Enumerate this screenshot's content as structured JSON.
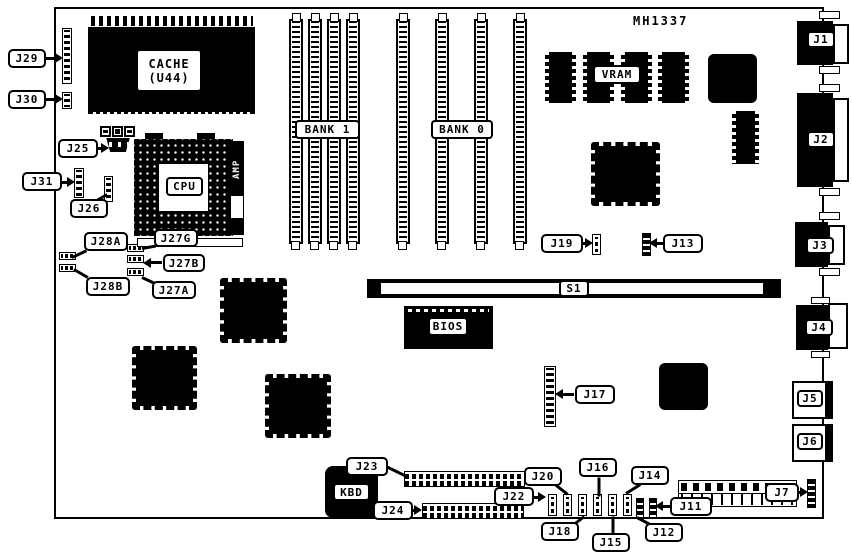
{
  "title_text": "MH1337",
  "components": {
    "cache_line1": "CACHE",
    "cache_line2": "(U44)",
    "cpu": "CPU",
    "amp": "AMP",
    "bank1": "BANK 1",
    "bank0": "BANK 0",
    "vram": "VRAM",
    "bios": "BIOS",
    "s1": "S1",
    "kbd": "KBD"
  },
  "jumpers": {
    "j29": "J29",
    "j30": "J30",
    "j25": "J25",
    "j31": "J31",
    "j26": "J26",
    "j28a": "J28A",
    "j28b": "J28B",
    "j27g": "J27G",
    "j27b": "J27B",
    "j27a": "J27A",
    "j19": "J19",
    "j13": "J13",
    "j17": "J17",
    "j23": "J23",
    "j24": "J24",
    "j22": "J22",
    "j20": "J20",
    "j18": "J18",
    "j16": "J16",
    "j15": "J15",
    "j14": "J14",
    "j12": "J12",
    "j11": "J11",
    "j7": "J7"
  },
  "ports": {
    "j1": "J1",
    "j2": "J2",
    "j3": "J3",
    "j4": "J4",
    "j5": "J5",
    "j6": "J6"
  },
  "colors": {
    "ink": "#000000",
    "paper": "#ffffff"
  }
}
